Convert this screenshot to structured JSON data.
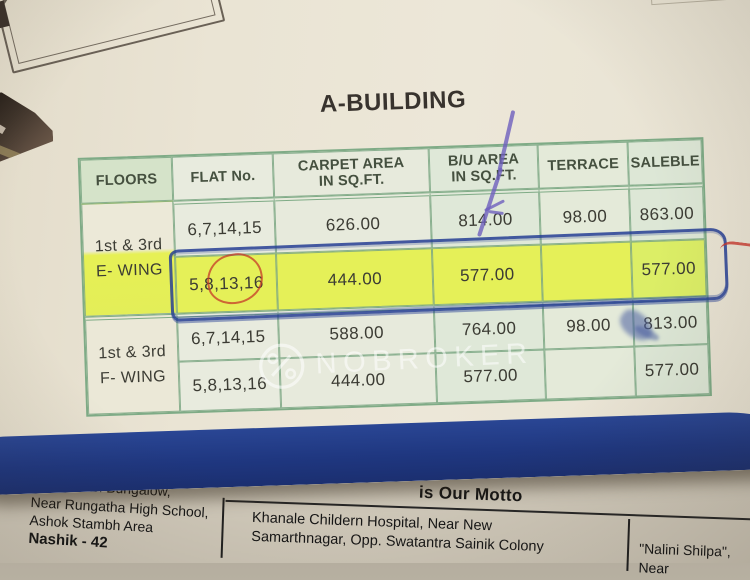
{
  "title": "A-BUILDING",
  "table": {
    "columns": [
      {
        "line1": "FLOORS",
        "line2": ""
      },
      {
        "line1": "FLAT No.",
        "line2": ""
      },
      {
        "line1": "CARPET AREA",
        "line2": "IN SQ.FT."
      },
      {
        "line1": "B/U AREA",
        "line2": "IN SQ.FT."
      },
      {
        "line1": "TERRACE",
        "line2": ""
      },
      {
        "line1": "SALEBLE",
        "line2": ""
      }
    ]
  },
  "groups": [
    {
      "floors_label": "1st & 3rd",
      "wing_label": "E- WING",
      "rows": [
        {
          "flat": "6,7,14,15",
          "carpet": "626.00",
          "bu": "814.00",
          "terrace": "98.00",
          "saleble": "863.00",
          "highlighted": false
        },
        {
          "flat": "5,8,13,16",
          "carpet": "444.00",
          "bu": "577.00",
          "terrace": "",
          "saleble": "577.00",
          "highlighted": true
        }
      ]
    },
    {
      "floors_label": "1st & 3rd",
      "wing_label": "F- WING",
      "rows": [
        {
          "flat": "6,7,14,15",
          "carpet": "588.00",
          "bu": "764.00",
          "terrace": "98.00",
          "saleble": "813.00",
          "highlighted": false
        },
        {
          "flat": "5,8,13,16",
          "carpet": "444.00",
          "bu": "577.00",
          "terrace": "",
          "saleble": "577.00",
          "highlighted": false
        }
      ]
    }
  ],
  "floorplan_fragment": {
    "label": "TER",
    "dimension": "9'9\"X4'6\""
  },
  "watermark": {
    "text": "NOBROKER",
    "logo": "nobroker-key-logo"
  },
  "bottom_page": {
    "motto_partial": "is Our Motto",
    "left_address_lines": [
      "Shriganesh Bungalow,",
      "Near Rungatha High School,",
      "Ashok Stambh Area",
      "Nashik - 42"
    ],
    "middle_address_lines": [
      "Khanale Childern Hospital, Near New",
      "Samarthnagar, Opp. Swatantra Sainik Colony"
    ],
    "right_address_lines": [
      "\"Nalini Shilpa\",",
      "Near"
    ]
  },
  "colors": {
    "paper_cream": "#eae4d4",
    "table_header_green": "#d5e3c9",
    "table_border_green": "#7fab86",
    "highlighter_yellow": "#e5f058",
    "pen_blue": "#263e94",
    "pen_red": "#c63a28",
    "pen_purple": "#6e5fbe",
    "band_blue": "#1f3780",
    "under_page_gray": "#d0c9ba"
  }
}
